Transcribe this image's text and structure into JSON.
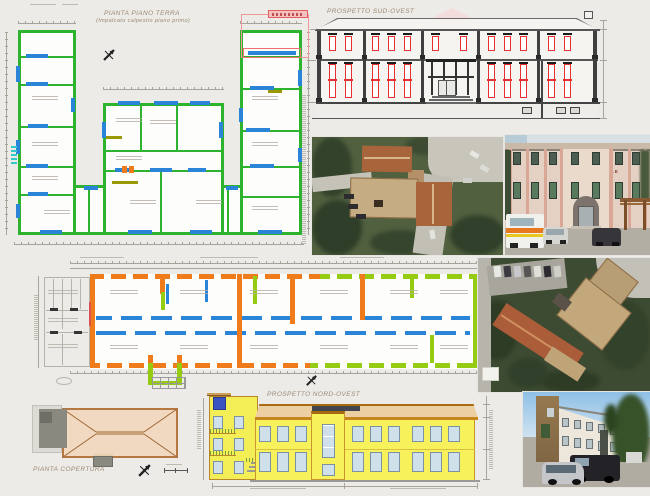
{
  "titles": {
    "ground_floor_plan": "PIANTA PIANO TERRA",
    "ground_floor_plan_sub": "(Impalcato calpestio piano primo)",
    "sw_elevation": "PROSPETTO SUD-OVEST",
    "roof_plan": "PIANTA COPERTURA",
    "nw_elevation": "PROSPETTO NORD-OVEST"
  },
  "photos": {
    "facade_sign": "OSPEDALE CIVILE"
  },
  "colors": {
    "plan_wall_green": "#2db32d",
    "plan_opening_blue": "#2a85d8",
    "plan_wall_orange": "#ef7b1a",
    "plan_wall_lime": "#95cc11",
    "elevation_window_red": "#e83030",
    "elevation_facade_yellow": "#f7f15b",
    "roof_plan_tan": "#f0d9c0",
    "annotation_red": "#ee7070",
    "background": "#ecebe8"
  },
  "icons": {
    "north_arrow": "stylized-plane-cross"
  }
}
